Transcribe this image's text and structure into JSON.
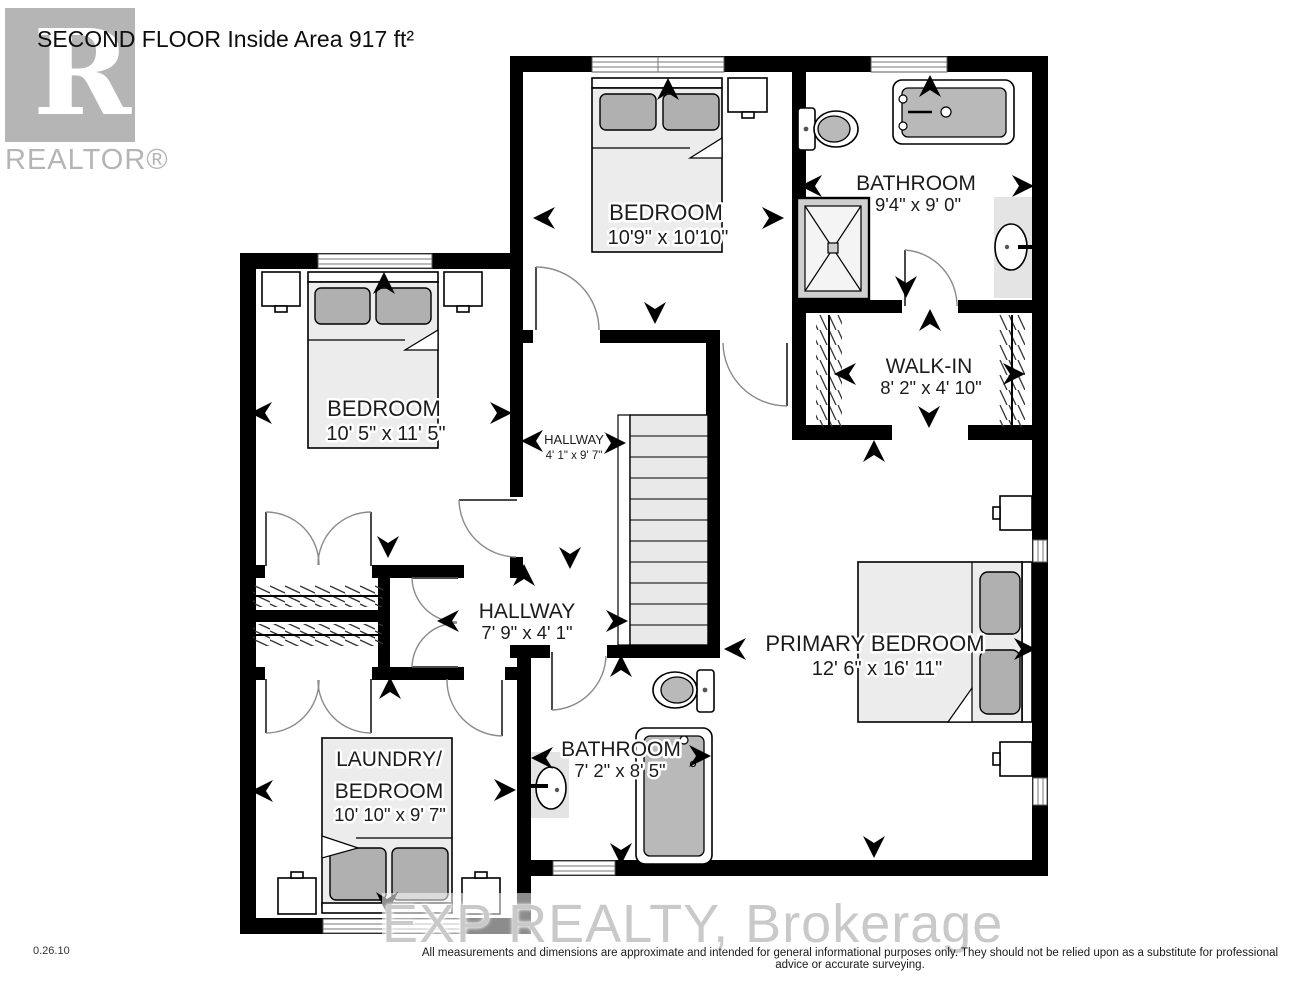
{
  "header": {
    "title": "SECOND FLOOR Inside Area 917 ft²"
  },
  "branding": {
    "realtor_logo_letter": "R",
    "realtor_logo_text": "REALTOR®",
    "watermark": "EXP REALTY, Brokerage"
  },
  "rooms": {
    "bedroom_top": {
      "name": "BEDROOM",
      "dims": "10'9\" x 10'10\""
    },
    "bathroom_top": {
      "name": "BATHROOM",
      "dims": "9'4\" x 9' 0\""
    },
    "walk_in": {
      "name": "WALK-IN",
      "dims": "8' 2\" x 4' 10\""
    },
    "bedroom_left": {
      "name": "BEDROOM",
      "dims": "10' 5\" x 11' 5\""
    },
    "hallway_upper": {
      "name": "HALLWAY",
      "dims": "4' 1\" x 9' 7\""
    },
    "hallway_lower": {
      "name": "HALLWAY",
      "dims": "7' 9\" x 4' 1\""
    },
    "primary_bedroom": {
      "name": "PRIMARY BEDROOM",
      "dims": "12' 6\" x 16' 11\""
    },
    "laundry_bedroom": {
      "name_line1": "LAUNDRY/",
      "name_line2": "BEDROOM",
      "dims": "10' 10\" x 9' 7\""
    },
    "bathroom_lower": {
      "name": "BATHROOM",
      "dims": "7' 2\" x 8' 5\""
    }
  },
  "footer": {
    "version": "0.26.10",
    "disclaimer": "All measurements and dimensions are approximate and intended for general informational purposes only. They should not be relied upon as a substitute for professional advice or accurate surveying."
  },
  "colors": {
    "wall": "#000000",
    "furniture_gray": "#b9b9b9",
    "logo_gray": "#b5b5b5"
  }
}
